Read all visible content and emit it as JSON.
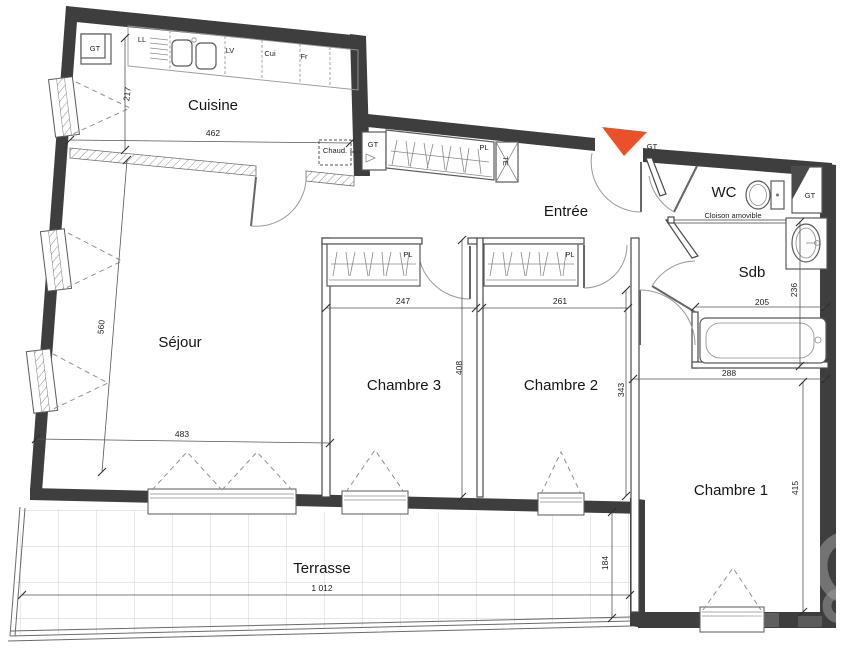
{
  "plan": {
    "rooms": {
      "cuisine": "Cuisine",
      "sejour": "Séjour",
      "entree": "Entrée",
      "wc": "WC",
      "sdb": "Sdb",
      "chambre1": "Chambre 1",
      "chambre2": "Chambre 2",
      "chambre3": "Chambre 3",
      "terrasse": "Terrasse"
    },
    "dimensions_cm": {
      "cuisine_depth": "217",
      "cuisine_width": "462",
      "sejour_height": "560",
      "sejour_width": "483",
      "chambre3_width": "247",
      "chambre3_height": "408",
      "chambre2_width": "261",
      "chambre2_height": "343",
      "sdb_width": "205",
      "sdb_height": "236",
      "chambre1_width": "288",
      "chambre1_height": "415",
      "terrasse_width": "1 012",
      "terrasse_depth": "184"
    },
    "annotations": {
      "gt": "GT",
      "ll": "LL",
      "lv": "LV",
      "cui": "Cui",
      "fr": "Fr",
      "chaud": "Chaud.",
      "pl": "PL",
      "te": "TE",
      "cloison_amovible": "Cloison amovible"
    },
    "colors": {
      "wall": "#3e3e3e",
      "entrance_marker": "#e8512a"
    }
  }
}
